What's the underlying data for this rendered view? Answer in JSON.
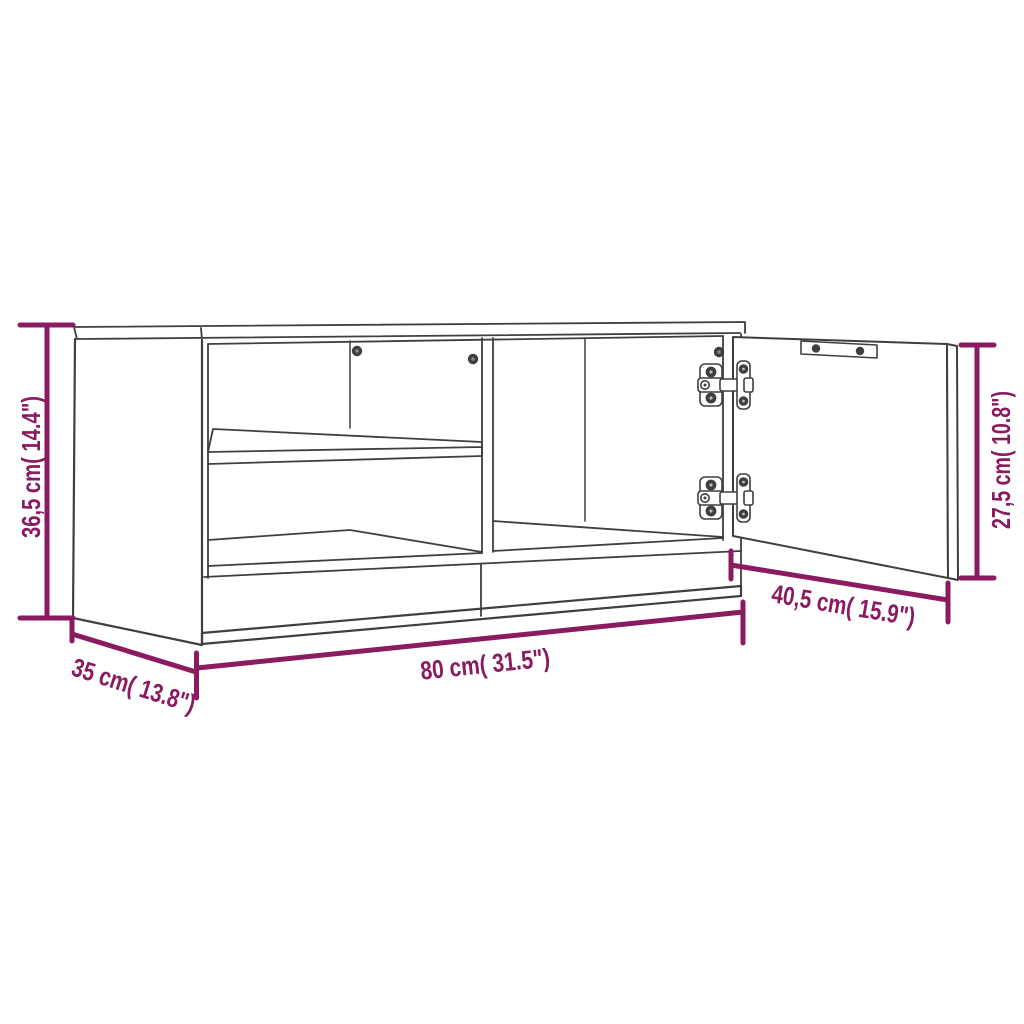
{
  "diagram": {
    "type": "furniture-dimension-diagram",
    "product": "TV cabinet with shelves and one open hinged door",
    "accent_color": "#8A1B60",
    "line_color": "#3F3F3F",
    "dimensions": {
      "height": "36,5 cm( 14.4\")",
      "depth": "35 cm( 13.8\")",
      "width": "80 cm( 31.5\")",
      "door_width": "40,5 cm( 15.9\")",
      "door_height": "27,5 cm( 10.8\")"
    }
  }
}
